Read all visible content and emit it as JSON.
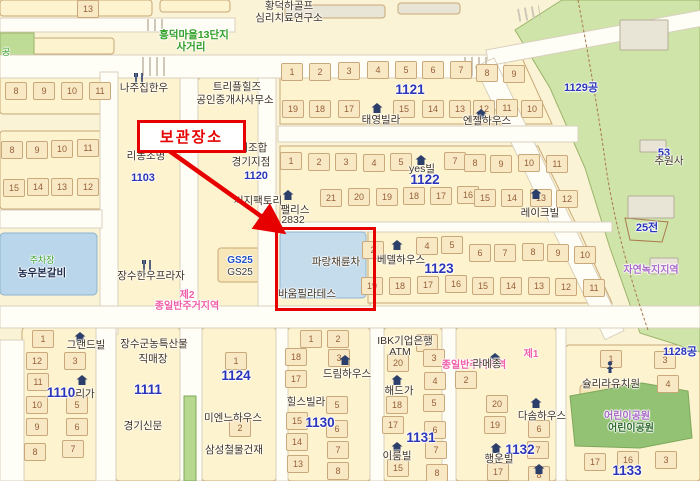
{
  "annotation": {
    "label": "보관장소",
    "box": {
      "x": 137,
      "y": 120,
      "w": 103,
      "h": 27
    },
    "arrow": {
      "x1": 168,
      "y1": 150,
      "x2": 279,
      "y2": 229
    },
    "highlight_frame": {
      "x": 275,
      "y": 227,
      "w": 95,
      "h": 78
    },
    "color": "#e60000"
  },
  "colors": {
    "block_fill": "#fdf3cf",
    "block_edge": "#c9a878",
    "road": "#fffef6",
    "road_edge": "#d9d0bd",
    "park_light": "#cfe4a8",
    "park_dark": "#93c274",
    "water_blue": "#b9d6ea",
    "highlight_blue": "#c5dcec",
    "blue_number": "#2a35b8",
    "pink_zone": "#f05fa8",
    "purple_zone": "#a868c8",
    "red": "#e60000",
    "gray_building": "#e9e5d6"
  },
  "blocks": [
    {
      "x": 0,
      "y": 0,
      "w": 152,
      "h": 16
    },
    {
      "x": 160,
      "y": 0,
      "w": 70,
      "h": 12
    },
    {
      "x": 0,
      "y": 38,
      "w": 114,
      "h": 16
    },
    {
      "x": 285,
      "y": 5,
      "w": 100,
      "h": 13,
      "f": "#e9e5d6"
    },
    {
      "x": 398,
      "y": 3,
      "w": 62,
      "h": 11,
      "f": "#e9e5d6"
    },
    {
      "x": 525,
      "y": 32,
      "w": 30,
      "h": 20
    },
    {
      "x": 0,
      "y": 76,
      "w": 112,
      "h": 38
    },
    {
      "x": 0,
      "y": 131,
      "w": 104,
      "h": 78
    },
    {
      "x": 116,
      "y": 58,
      "w": 64,
      "h": 250
    },
    {
      "x": 198,
      "y": 78,
      "w": 62,
      "h": 228
    },
    {
      "x": 262,
      "y": 228,
      "w": 108,
      "h": 80
    },
    {
      "x": 22,
      "y": 328,
      "w": 78,
      "h": 153
    },
    {
      "x": 116,
      "y": 328,
      "w": 64,
      "h": 153
    },
    {
      "x": 202,
      "y": 328,
      "w": 74,
      "h": 153
    },
    {
      "x": 288,
      "y": 328,
      "w": 82,
      "h": 153
    },
    {
      "x": 384,
      "y": 328,
      "w": 58,
      "h": 153
    },
    {
      "x": 456,
      "y": 328,
      "w": 100,
      "h": 153
    },
    {
      "x": 566,
      "y": 345,
      "w": 134,
      "h": 136
    },
    {
      "x": 218,
      "y": 248,
      "w": 46,
      "h": 34,
      "f": "#f6e6b8"
    },
    {
      "x": 580,
      "y": 385,
      "w": 50,
      "h": 20,
      "f": "#f6e6b8"
    }
  ],
  "block_polys": [
    {
      "pts": "280,58 522,58 552,124 280,124"
    },
    {
      "pts": "280,146 538,146 578,228 280,228"
    },
    {
      "pts": "368,232 580,232 612,303 368,303"
    }
  ],
  "greens": [
    {
      "pts": "515,30 562,0 700,0 700,352 640,333 610,248 585,168 550,88",
      "f": "#cfe4a8"
    },
    {
      "pts": "0,33 34,33 34,73 0,73",
      "f": "#bfdc96"
    }
  ],
  "greens_top": [
    {
      "pts": "570,396 642,383 688,391 692,438 640,448 575,446",
      "f": "#93c274"
    },
    {
      "pts": "184,396 196,396 196,481 184,481",
      "f": "#b7d98f"
    }
  ],
  "park_boundary_path": "M578,0 Q595,90 605,160 Q615,235 648,330",
  "field_plot": {
    "pts": "625,218 668,222 662,242 630,240",
    "f": "none"
  },
  "roads": [
    {
      "x": 0,
      "y": 18,
      "w": 235,
      "h": 14
    },
    {
      "x": 0,
      "y": 55,
      "w": 505,
      "h": 23
    },
    {
      "x": 486,
      "y": 50,
      "w": 225,
      "h": 16,
      "r": -10.5
    },
    {
      "x": 494,
      "y": 58,
      "w": 302,
      "h": 21,
      "r": 64.5
    },
    {
      "x": 100,
      "y": 72,
      "w": 18,
      "h": 262
    },
    {
      "x": 0,
      "y": 210,
      "w": 102,
      "h": 18
    },
    {
      "x": 0,
      "y": 306,
      "w": 700,
      "h": 22
    },
    {
      "x": 180,
      "y": 78,
      "w": 18,
      "h": 228
    },
    {
      "x": 258,
      "y": 78,
      "w": 18,
      "h": 228
    },
    {
      "x": 278,
      "y": 126,
      "w": 300,
      "h": 16
    },
    {
      "x": 276,
      "y": 222,
      "w": 336,
      "h": 10
    },
    {
      "x": 96,
      "y": 328,
      "w": 20,
      "h": 153
    },
    {
      "x": 180,
      "y": 328,
      "w": 22,
      "h": 153
    },
    {
      "x": 276,
      "y": 328,
      "w": 12,
      "h": 153
    },
    {
      "x": 370,
      "y": 328,
      "w": 14,
      "h": 153
    },
    {
      "x": 442,
      "y": 328,
      "w": 14,
      "h": 153
    },
    {
      "x": 556,
      "y": 328,
      "w": 10,
      "h": 153
    },
    {
      "x": 0,
      "y": 340,
      "w": 24,
      "h": 141
    }
  ],
  "gray_buildings": [
    {
      "x": 620,
      "y": 20,
      "w": 48,
      "h": 30
    },
    {
      "x": 640,
      "y": 140,
      "w": 26,
      "h": 12
    },
    {
      "x": 628,
      "y": 196,
      "w": 46,
      "h": 22
    },
    {
      "x": 650,
      "y": 258,
      "w": 28,
      "h": 16
    }
  ],
  "blue_buildings": [
    {
      "x": 0,
      "y": 233,
      "w": 97,
      "h": 62,
      "f": "#b9d6ea"
    },
    {
      "x": 280,
      "y": 232,
      "w": 86,
      "h": 66,
      "f": "#c5dcec"
    }
  ],
  "crosswalks": [
    {
      "x": 142,
      "y": 57,
      "w": 26,
      "h": 19
    },
    {
      "x": 464,
      "y": 57,
      "w": 26,
      "h": 19
    },
    {
      "x": 518,
      "y": 7,
      "w": 22,
      "h": 13,
      "r": -10
    },
    {
      "x": 147,
      "y": 19,
      "w": 18,
      "h": 12
    }
  ],
  "labels": [
    {
      "t": "황덕하골프",
      "cx": 289,
      "y": 1
    },
    {
      "t": "심리치료연구소",
      "cx": 289,
      "y": 13
    },
    {
      "t": "흥덕마을13단지",
      "cx": 194,
      "y": 30,
      "c": "green"
    },
    {
      "t": "사거리",
      "cx": 191,
      "y": 42,
      "c": "green"
    },
    {
      "t": "공",
      "cx": 6,
      "y": 48,
      "c": "green2"
    },
    {
      "t": "나주집한우",
      "cx": 144,
      "y": 83
    },
    {
      "t": "트리플힐즈",
      "cx": 237,
      "y": 82
    },
    {
      "t": "공인중개사사무소",
      "cx": 235,
      "y": 95
    },
    {
      "t": "리농조명",
      "cx": 146,
      "y": 151
    },
    {
      "t": "1103",
      "cx": 143,
      "y": 173,
      "c": "bluenum"
    },
    {
      "t": "공제조합",
      "cx": 248,
      "y": 143
    },
    {
      "t": "경기지점",
      "cx": 251,
      "y": 157
    },
    {
      "t": "1120",
      "cx": 256,
      "y": 171,
      "c": "bluenum"
    },
    {
      "t": "씨지팩토리",
      "cx": 258,
      "y": 196
    },
    {
      "t": "1121",
      "cx": 410,
      "y": 83,
      "c": "bluenumbig"
    },
    {
      "t": "태영빌라",
      "cx": 381,
      "y": 115
    },
    {
      "t": "엔젤하우스",
      "cx": 487,
      "y": 116
    },
    {
      "t": "1129공",
      "cx": 581,
      "y": 83,
      "c": "bluenum"
    },
    {
      "t": "yes빌",
      "cx": 422,
      "y": 164
    },
    {
      "t": "1122",
      "cx": 425,
      "y": 173,
      "c": "bluenumbig"
    },
    {
      "t": "레이크빌",
      "cx": 540,
      "y": 208
    },
    {
      "t": "팰리스",
      "cx": 295,
      "y": 205
    },
    {
      "t": "2832",
      "cx": 293,
      "y": 215
    },
    {
      "t": "53",
      "cx": 664,
      "y": 148,
      "c": "bluenum"
    },
    {
      "t": "추원사",
      "cx": 669,
      "y": 156
    },
    {
      "t": "25전",
      "cx": 647,
      "y": 223,
      "c": "bluenum"
    },
    {
      "t": "파랑채륜차",
      "cx": 336,
      "y": 257
    },
    {
      "t": "바움필라테스",
      "cx": 307,
      "y": 289
    },
    {
      "t": "베델하우스",
      "cx": 401,
      "y": 255
    },
    {
      "t": "1123",
      "cx": 439,
      "y": 262,
      "c": "bluenumbig"
    },
    {
      "t": "GS25",
      "cx": 240,
      "y": 256,
      "c": "gslogo"
    },
    {
      "t": "GS25",
      "cx": 240,
      "y": 268,
      "c": "gsdark"
    },
    {
      "t": "주차장",
      "cx": 42,
      "y": 256,
      "c": "green2"
    },
    {
      "t": "농우본갈비",
      "cx": 42,
      "y": 268,
      "c": "navy"
    },
    {
      "t": "장수한우프라자",
      "cx": 151,
      "y": 271
    },
    {
      "t": "제2",
      "cx": 187,
      "y": 291,
      "c": "pink"
    },
    {
      "t": "종일반주거지역",
      "cx": 187,
      "y": 302,
      "c": "pink"
    },
    {
      "t": "자연녹지지역",
      "cx": 651,
      "y": 266,
      "c": "purple"
    },
    {
      "t": "그랜드빌",
      "cx": 86,
      "y": 340
    },
    {
      "t": "장수군농특산물",
      "cx": 154,
      "y": 339
    },
    {
      "t": "직매장",
      "cx": 153,
      "y": 354
    },
    {
      "t": "1124",
      "cx": 236,
      "y": 369,
      "c": "bluenumbig"
    },
    {
      "t": "1110",
      "cx": 61,
      "y": 386,
      "c": "bluenumbig"
    },
    {
      "t": "리가",
      "cx": 85,
      "y": 389
    },
    {
      "t": "1111",
      "cx": 148,
      "y": 383,
      "c": "bluenumbig"
    },
    {
      "t": "경기신문",
      "cx": 143,
      "y": 421
    },
    {
      "t": "미엔느하우스",
      "cx": 233,
      "y": 413
    },
    {
      "t": "삼성철물건재",
      "cx": 234,
      "y": 445
    },
    {
      "t": "드림하우스",
      "cx": 347,
      "y": 369
    },
    {
      "t": "힐스빌라",
      "cx": 306,
      "y": 397
    },
    {
      "t": "1130",
      "cx": 320,
      "y": 416,
      "c": "bluenumbig"
    },
    {
      "t": "IBK기업은행",
      "cx": 405,
      "y": 336
    },
    {
      "t": "ATM",
      "cx": 400,
      "y": 347
    },
    {
      "t": "해드가",
      "cx": 399,
      "y": 386
    },
    {
      "t": "1131",
      "cx": 421,
      "y": 431,
      "c": "bluenumbig"
    },
    {
      "t": "이룸빌",
      "cx": 397,
      "y": 451
    },
    {
      "t": "제1",
      "cx": 531,
      "y": 350,
      "c": "pink"
    },
    {
      "t": "종일반주거지역",
      "cx": 474,
      "y": 361,
      "c": "pink"
    },
    {
      "t": "라메종",
      "cx": 487,
      "y": 359
    },
    {
      "t": "다솜하우스",
      "cx": 542,
      "y": 411
    },
    {
      "t": "1132",
      "cx": 520,
      "y": 443,
      "c": "bluenumbig"
    },
    {
      "t": "행운빌",
      "cx": 499,
      "y": 454
    },
    {
      "t": "슐리라유치원",
      "cx": 611,
      "y": 379
    },
    {
      "t": "어린이공원",
      "cx": 627,
      "y": 412,
      "c": "purple"
    },
    {
      "t": "어린이공원",
      "cx": 631,
      "y": 424,
      "c": "parkgreen"
    },
    {
      "t": "1133",
      "cx": 627,
      "y": 464,
      "c": "bluenumbig"
    },
    {
      "t": "1128공",
      "cx": 680,
      "y": 347,
      "c": "bluenum"
    }
  ],
  "parcels": [
    {
      "n": "13",
      "x": 88,
      "y": 0
    },
    {
      "n": "8",
      "x": 16,
      "y": 82
    },
    {
      "n": "9",
      "x": 44,
      "y": 82
    },
    {
      "n": "10",
      "x": 72,
      "y": 82
    },
    {
      "n": "11",
      "x": 100,
      "y": 82
    },
    {
      "n": "8",
      "x": 12,
      "y": 141
    },
    {
      "n": "9",
      "x": 37,
      "y": 141
    },
    {
      "n": "10",
      "x": 62,
      "y": 140
    },
    {
      "n": "11",
      "x": 88,
      "y": 139
    },
    {
      "n": "15",
      "x": 14,
      "y": 179
    },
    {
      "n": "14",
      "x": 38,
      "y": 178
    },
    {
      "n": "13",
      "x": 62,
      "y": 178
    },
    {
      "n": "12",
      "x": 88,
      "y": 178
    },
    {
      "n": "1",
      "x": 292,
      "y": 63
    },
    {
      "n": "2",
      "x": 320,
      "y": 63
    },
    {
      "n": "3",
      "x": 349,
      "y": 62
    },
    {
      "n": "4",
      "x": 378,
      "y": 61
    },
    {
      "n": "5",
      "x": 406,
      "y": 61
    },
    {
      "n": "6",
      "x": 433,
      "y": 61
    },
    {
      "n": "7",
      "x": 461,
      "y": 61
    },
    {
      "n": "8",
      "x": 487,
      "y": 64
    },
    {
      "n": "9",
      "x": 514,
      "y": 65
    },
    {
      "n": "19",
      "x": 293,
      "y": 100
    },
    {
      "n": "18",
      "x": 320,
      "y": 100
    },
    {
      "n": "17",
      "x": 349,
      "y": 100
    },
    {
      "n": "15",
      "x": 404,
      "y": 100
    },
    {
      "n": "14",
      "x": 433,
      "y": 100
    },
    {
      "n": "13",
      "x": 460,
      "y": 100
    },
    {
      "n": "12",
      "x": 484,
      "y": 100
    },
    {
      "n": "11",
      "x": 507,
      "y": 99
    },
    {
      "n": "10",
      "x": 532,
      "y": 100
    },
    {
      "n": "1",
      "x": 291,
      "y": 152
    },
    {
      "n": "2",
      "x": 319,
      "y": 153
    },
    {
      "n": "3",
      "x": 346,
      "y": 153
    },
    {
      "n": "4",
      "x": 374,
      "y": 154
    },
    {
      "n": "5",
      "x": 401,
      "y": 153
    },
    {
      "n": "7",
      "x": 455,
      "y": 152
    },
    {
      "n": "8",
      "x": 475,
      "y": 154
    },
    {
      "n": "9",
      "x": 501,
      "y": 155
    },
    {
      "n": "10",
      "x": 529,
      "y": 154
    },
    {
      "n": "11",
      "x": 557,
      "y": 155
    },
    {
      "n": "21",
      "x": 331,
      "y": 189
    },
    {
      "n": "20",
      "x": 359,
      "y": 188
    },
    {
      "n": "19",
      "x": 387,
      "y": 188
    },
    {
      "n": "18",
      "x": 414,
      "y": 187
    },
    {
      "n": "17",
      "x": 441,
      "y": 187
    },
    {
      "n": "16",
      "x": 468,
      "y": 186
    },
    {
      "n": "15",
      "x": 485,
      "y": 189
    },
    {
      "n": "14",
      "x": 512,
      "y": 189
    },
    {
      "n": "13",
      "x": 541,
      "y": 189
    },
    {
      "n": "12",
      "x": 567,
      "y": 190
    },
    {
      "n": "2",
      "x": 373,
      "y": 241
    },
    {
      "n": "4",
      "x": 427,
      "y": 237
    },
    {
      "n": "5",
      "x": 452,
      "y": 236
    },
    {
      "n": "6",
      "x": 480,
      "y": 244
    },
    {
      "n": "7",
      "x": 505,
      "y": 244
    },
    {
      "n": "8",
      "x": 533,
      "y": 243
    },
    {
      "n": "9",
      "x": 558,
      "y": 244
    },
    {
      "n": "10",
      "x": 585,
      "y": 246
    },
    {
      "n": "19",
      "x": 372,
      "y": 277
    },
    {
      "n": "18",
      "x": 400,
      "y": 277
    },
    {
      "n": "17",
      "x": 428,
      "y": 276
    },
    {
      "n": "16",
      "x": 456,
      "y": 275
    },
    {
      "n": "15",
      "x": 483,
      "y": 277
    },
    {
      "n": "14",
      "x": 511,
      "y": 277
    },
    {
      "n": "13",
      "x": 539,
      "y": 277
    },
    {
      "n": "12",
      "x": 566,
      "y": 278
    },
    {
      "n": "11",
      "x": 594,
      "y": 279
    },
    {
      "n": "1",
      "x": 43,
      "y": 330
    },
    {
      "n": "12",
      "x": 37,
      "y": 352
    },
    {
      "n": "3",
      "x": 75,
      "y": 352
    },
    {
      "n": "11",
      "x": 38,
      "y": 373
    },
    {
      "n": "10",
      "x": 37,
      "y": 396
    },
    {
      "n": "5",
      "x": 77,
      "y": 396
    },
    {
      "n": "9",
      "x": 37,
      "y": 418
    },
    {
      "n": "6",
      "x": 77,
      "y": 418
    },
    {
      "n": "8",
      "x": 35,
      "y": 443
    },
    {
      "n": "7",
      "x": 73,
      "y": 440
    },
    {
      "n": "1",
      "x": 236,
      "y": 352
    },
    {
      "n": "2",
      "x": 240,
      "y": 419
    },
    {
      "n": "1",
      "x": 311,
      "y": 330
    },
    {
      "n": "2",
      "x": 338,
      "y": 330
    },
    {
      "n": "18",
      "x": 296,
      "y": 348
    },
    {
      "n": "17",
      "x": 296,
      "y": 370
    },
    {
      "n": "15",
      "x": 297,
      "y": 412
    },
    {
      "n": "14",
      "x": 297,
      "y": 433
    },
    {
      "n": "13",
      "x": 298,
      "y": 455
    },
    {
      "n": "3",
      "x": 339,
      "y": 349
    },
    {
      "n": "5",
      "x": 337,
      "y": 396
    },
    {
      "n": "6",
      "x": 337,
      "y": 420
    },
    {
      "n": "7",
      "x": 338,
      "y": 441
    },
    {
      "n": "8",
      "x": 338,
      "y": 462
    },
    {
      "n": "2",
      "x": 427,
      "y": 334
    },
    {
      "n": "20",
      "x": 398,
      "y": 354
    },
    {
      "n": "3",
      "x": 434,
      "y": 349
    },
    {
      "n": "4",
      "x": 435,
      "y": 372
    },
    {
      "n": "18",
      "x": 397,
      "y": 396
    },
    {
      "n": "5",
      "x": 434,
      "y": 394
    },
    {
      "n": "17",
      "x": 393,
      "y": 416
    },
    {
      "n": "6",
      "x": 435,
      "y": 421
    },
    {
      "n": "7",
      "x": 436,
      "y": 441
    },
    {
      "n": "15",
      "x": 398,
      "y": 459
    },
    {
      "n": "8",
      "x": 437,
      "y": 464
    },
    {
      "n": "2",
      "x": 466,
      "y": 371
    },
    {
      "n": "20",
      "x": 497,
      "y": 395
    },
    {
      "n": "19",
      "x": 495,
      "y": 416
    },
    {
      "n": "6",
      "x": 539,
      "y": 420
    },
    {
      "n": "7",
      "x": 538,
      "y": 441
    },
    {
      "n": "17",
      "x": 498,
      "y": 463
    },
    {
      "n": "8",
      "x": 539,
      "y": 466
    },
    {
      "n": "1",
      "x": 611,
      "y": 350
    },
    {
      "n": "3",
      "x": 665,
      "y": 351
    },
    {
      "n": "4",
      "x": 668,
      "y": 375
    },
    {
      "n": "17",
      "x": 595,
      "y": 453
    },
    {
      "n": "16",
      "x": 628,
      "y": 451
    },
    {
      "n": "3",
      "x": 666,
      "y": 451
    }
  ],
  "icons": [
    {
      "k": "restaurant",
      "x": 139,
      "y": 72
    },
    {
      "k": "restaurant",
      "x": 147,
      "y": 259
    },
    {
      "k": "house",
      "x": 377,
      "y": 100
    },
    {
      "k": "house",
      "x": 481,
      "y": 106
    },
    {
      "k": "house",
      "x": 421,
      "y": 152
    },
    {
      "k": "house",
      "x": 288,
      "y": 187
    },
    {
      "k": "house",
      "x": 536,
      "y": 186
    },
    {
      "k": "house",
      "x": 397,
      "y": 237
    },
    {
      "k": "house",
      "x": 82,
      "y": 372
    },
    {
      "k": "house",
      "x": 80,
      "y": 329
    },
    {
      "k": "house",
      "x": 345,
      "y": 352
    },
    {
      "k": "house",
      "x": 397,
      "y": 372
    },
    {
      "k": "house",
      "x": 397,
      "y": 439
    },
    {
      "k": "house",
      "x": 536,
      "y": 395
    },
    {
      "k": "house",
      "x": 496,
      "y": 440
    },
    {
      "k": "house",
      "x": 539,
      "y": 461
    },
    {
      "k": "house",
      "x": 495,
      "y": 350
    },
    {
      "k": "person",
      "x": 610,
      "y": 360
    }
  ]
}
